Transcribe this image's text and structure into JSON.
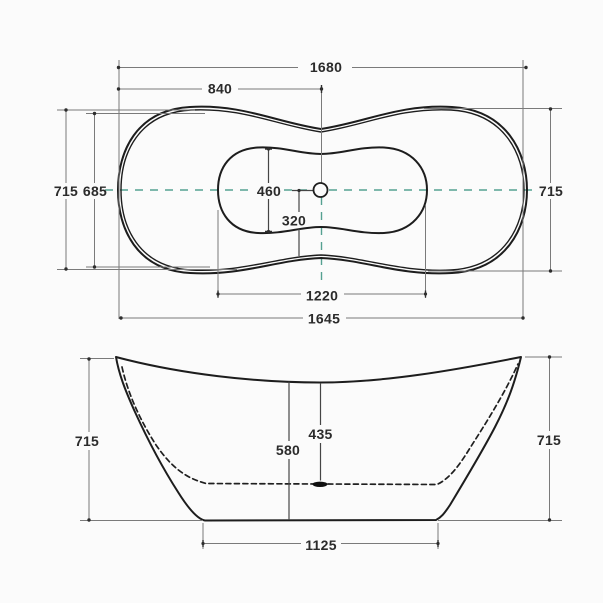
{
  "drawing": {
    "title": "bathtub-dimension-drawing",
    "colors": {
      "background": "#fbfbfb",
      "outline": "#1d1d1d",
      "dimension_lines": "#7a7a7a",
      "centerline": "#55a191",
      "text": "#2b2b2b"
    },
    "top_view": {
      "length_overall": "1680",
      "length_half": "840",
      "width_overall_left": "715",
      "width_inner": "685",
      "width_overall_right": "715",
      "basin_width": "460",
      "drain_to_edge": "320",
      "basin_length": "1220",
      "length_base": "1645"
    },
    "front_view": {
      "height_left": "715",
      "height_right": "715",
      "depth_inner": "435",
      "depth_wall": "580",
      "base_length": "1125"
    }
  }
}
